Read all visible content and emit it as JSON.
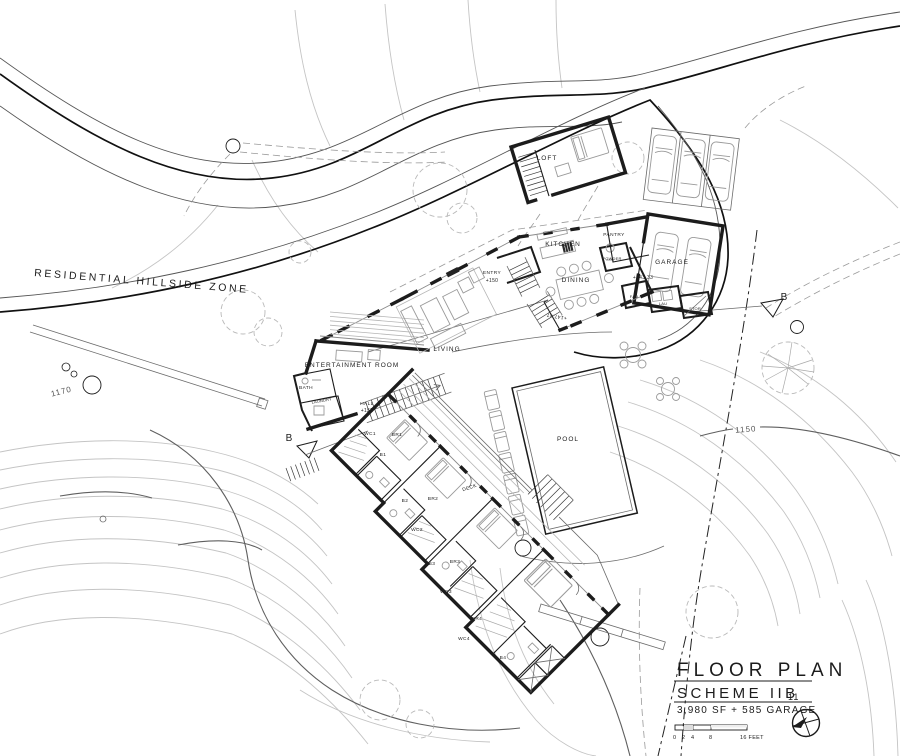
{
  "site": {
    "zone_label": "RESIDENTIAL HILLSIDE ZONE",
    "contour_left": "1170",
    "contour_right": "1150",
    "section_left": "B",
    "section_right": "B"
  },
  "plan": {
    "rooms": {
      "loft": "LOFT",
      "kitchen": "KITCHEN",
      "pantry": "PANTRY",
      "powder": "POWDER",
      "garage": "GARAGE",
      "garage_elev": "+143.33",
      "dining": "DINING",
      "dining_elev": "+147.47",
      "entry": "ENTRY",
      "entry_elev": "+150",
      "living": "LIVING",
      "entertainment": "ENTERTAINMENT ROOM",
      "bath": "BATH",
      "laundry": "LAUNDRY",
      "hall": "HALL",
      "hall_elev": "+152",
      "fau": "FAU",
      "lau": "LAU",
      "stor": "STOR",
      "br1": "BR1",
      "b1": "B1",
      "wc1": "WC1",
      "br2": "BR2",
      "b2": "B2",
      "wc2": "WC2",
      "br3": "BR3",
      "b3": "B3",
      "wc3": "WC3",
      "br4": "BR4",
      "b4": "B4",
      "wc4": "WC4",
      "deck": "DECK",
      "pool": "POOL"
    }
  },
  "title_block": {
    "title": "FLOOR PLAN",
    "scheme": "SCHEME IIB",
    "scheme_sub": "11",
    "area": "3,980 SF + 585 GARAGE",
    "scale_0": "0",
    "scale_2": "2",
    "scale_4": "4",
    "scale_8": "8",
    "scale_16": "16 FEET"
  },
  "colors": {
    "ink": "#1c1c1c",
    "contour": "#c4c4c4",
    "furniture": "#9a9a9a",
    "background": "#ffffff"
  }
}
